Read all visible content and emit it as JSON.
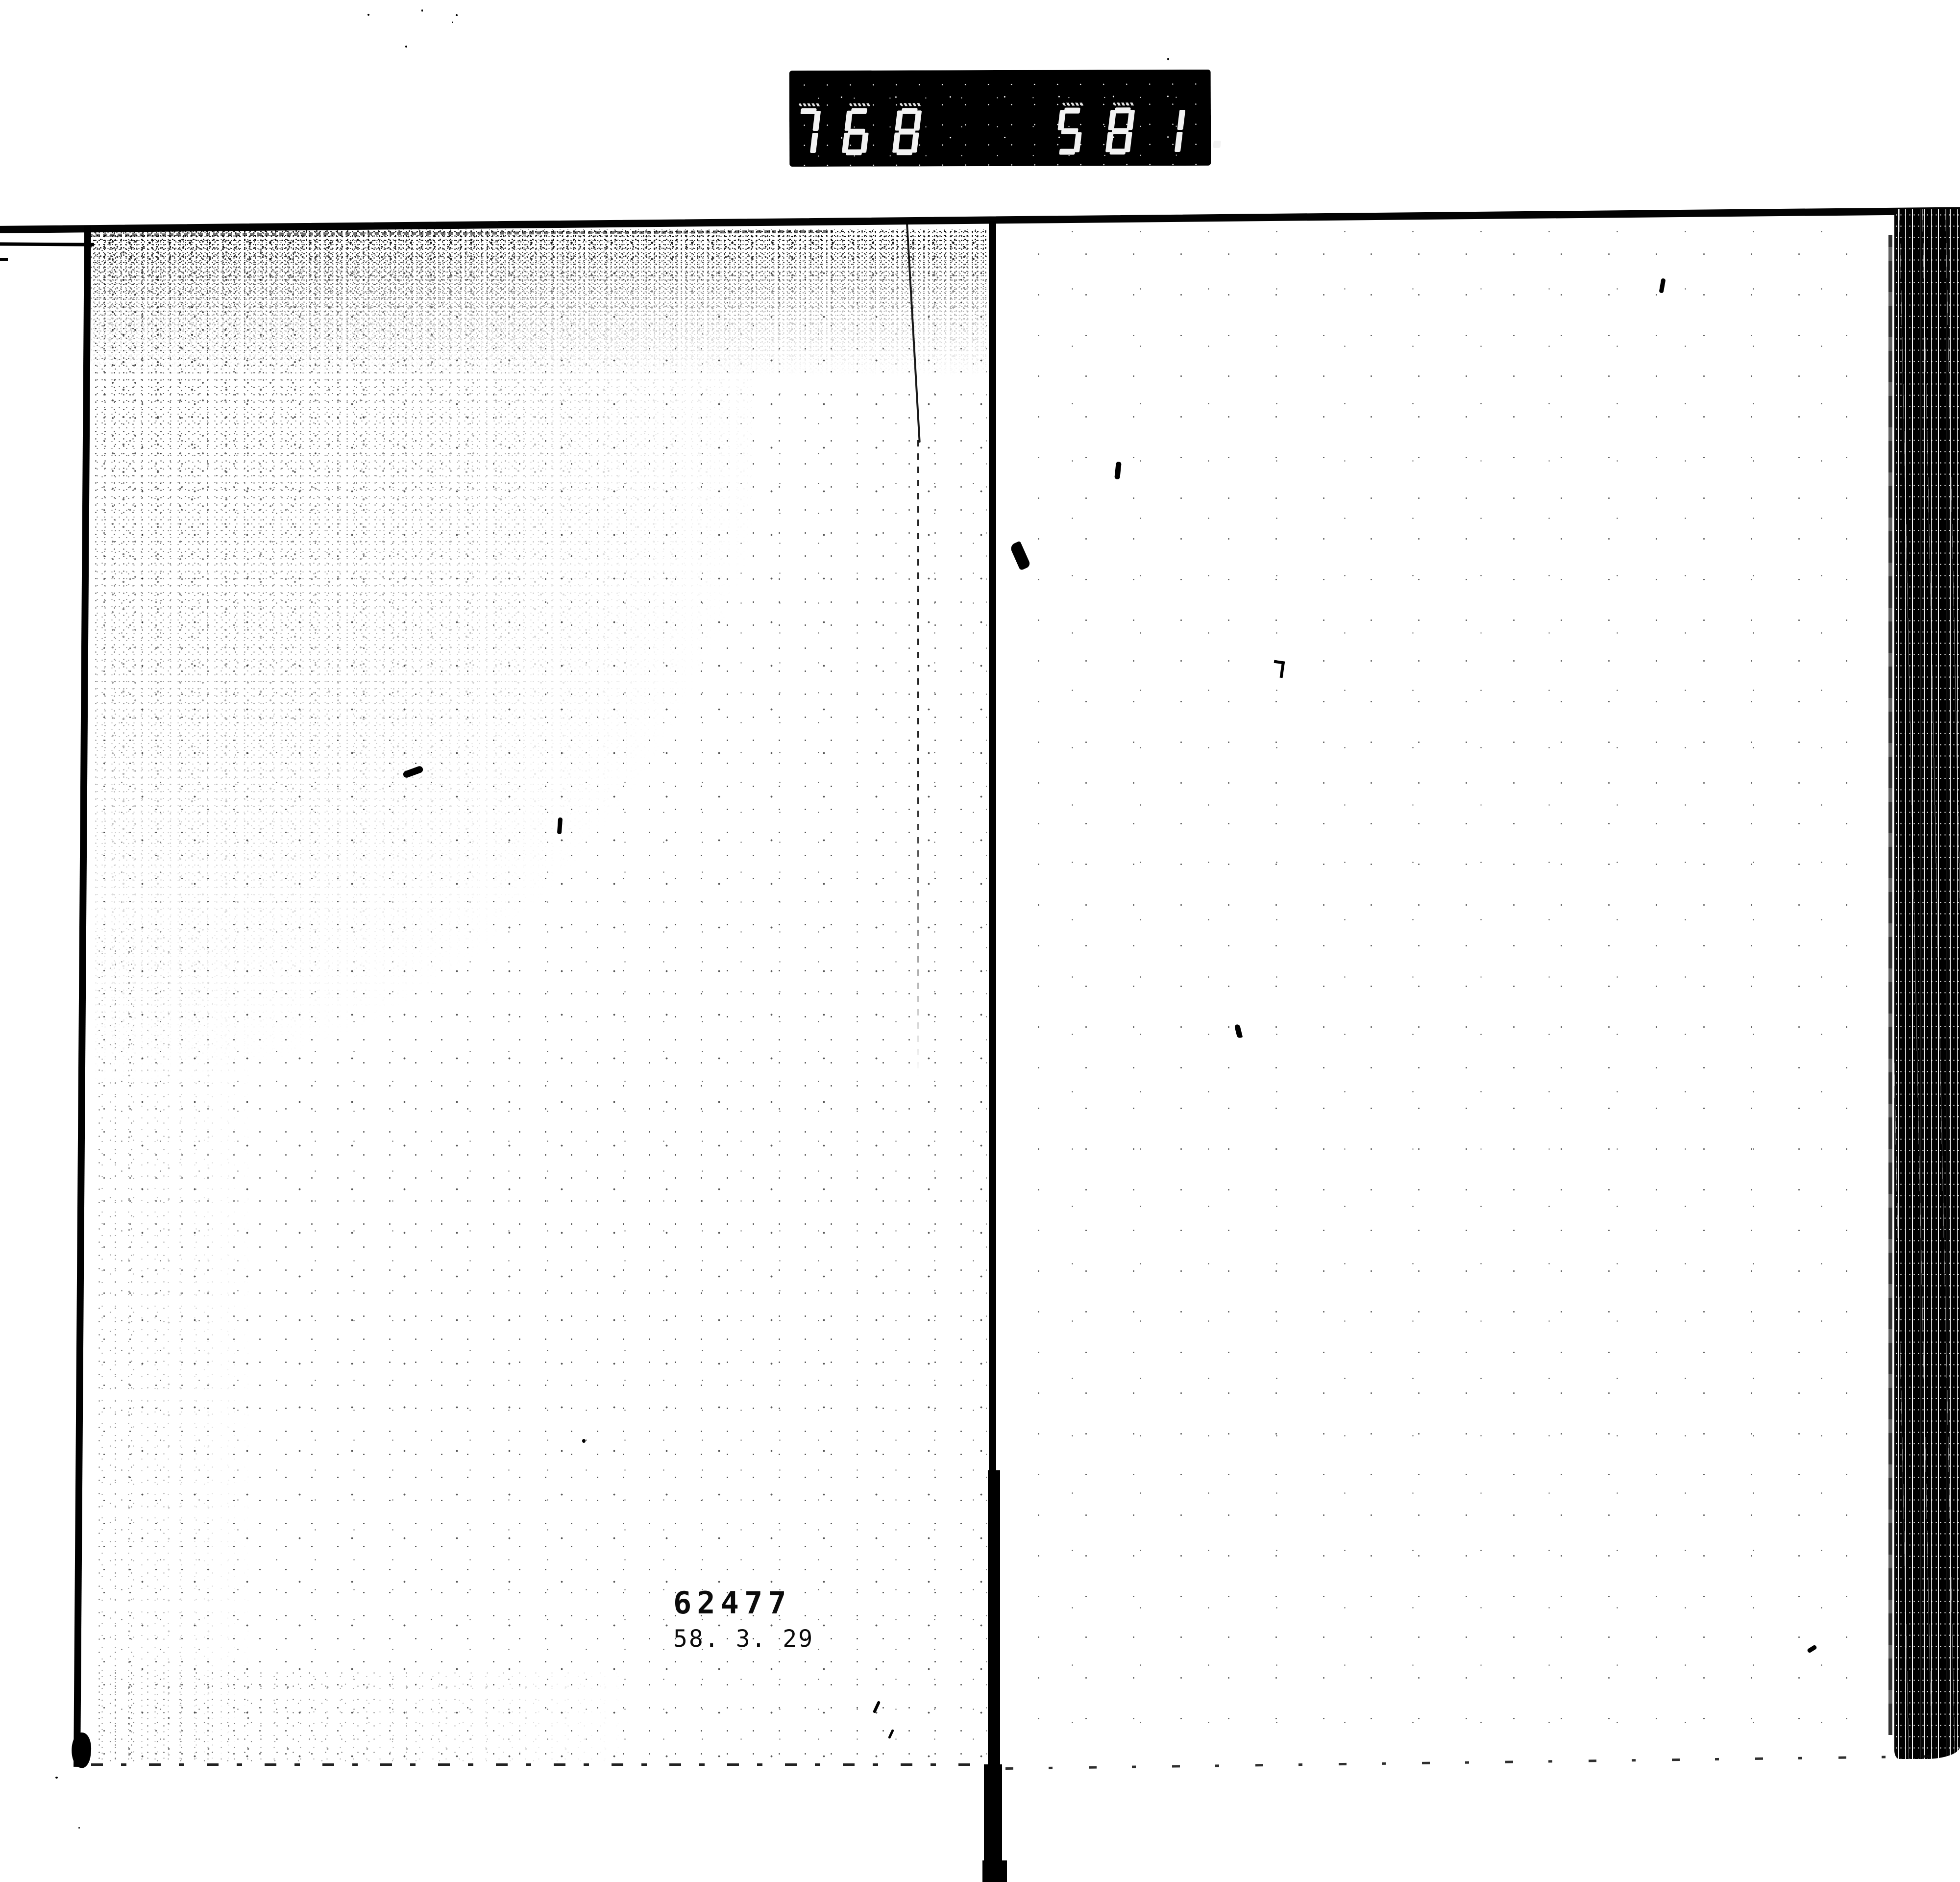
{
  "frame_counter": {
    "left_value": "768",
    "right_value": "581.",
    "background_color": "#000000",
    "digit_color": "#f2f2f2"
  },
  "stamp": {
    "line1": "62477",
    "line2": "58. 3. 29",
    "ink_color": "#0b0b0b"
  },
  "scan": {
    "paper_color": "#ffffff",
    "ink_color": "#000000"
  }
}
